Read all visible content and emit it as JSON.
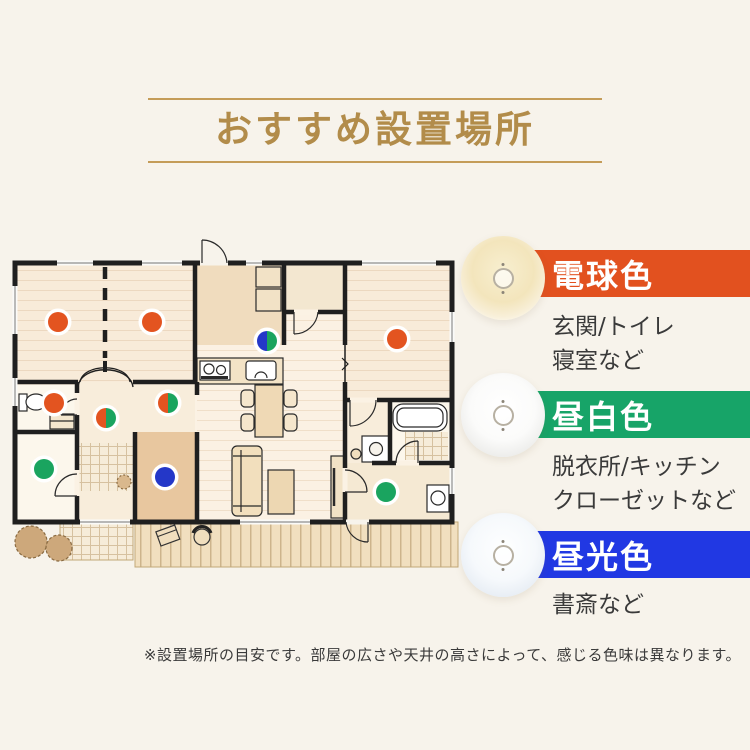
{
  "title": {
    "text": "おすすめ設置場所",
    "accent_color": "#B28C4A",
    "line_color": "#C49C58"
  },
  "legend": {
    "items": [
      {
        "label": "電球色",
        "banner_color": "#E2511F",
        "light_tint": "#F5E8C4",
        "desc_lines": [
          "玄関/トイレ",
          "寝室など"
        ]
      },
      {
        "label": "昼白色",
        "banner_color": "#17A468",
        "light_tint": "#FFFFFF",
        "desc_lines": [
          "脱衣所/キッチン",
          "クローゼットなど"
        ]
      },
      {
        "label": "昼光色",
        "banner_color": "#2138E3",
        "light_tint": "#F3F7FC",
        "desc_lines": [
          "書斎など"
        ]
      }
    ]
  },
  "footnote": {
    "text": "※設置場所の目安です。部屋の広さや天井の高さによって、感じる色味は異なります。"
  },
  "floorplan": {
    "dot_colors": {
      "warm": "#E35420",
      "neutral": "#1AA45F",
      "cool": "#2437C8"
    },
    "dots": [
      {
        "x": 58,
        "y": 92,
        "type": "warm",
        "room": "bedroom-1"
      },
      {
        "x": 152,
        "y": 92,
        "type": "warm",
        "room": "bedroom-2"
      },
      {
        "x": 397,
        "y": 109,
        "type": "warm",
        "room": "bedroom-3"
      },
      {
        "x": 267,
        "y": 111,
        "type": "cool_neutral",
        "room": "kitchen"
      },
      {
        "x": 54,
        "y": 173,
        "type": "warm",
        "room": "toilet"
      },
      {
        "x": 106,
        "y": 188,
        "type": "warm_neutral",
        "room": "entrance-hall"
      },
      {
        "x": 168,
        "y": 173,
        "type": "warm_neutral",
        "room": "hallway"
      },
      {
        "x": 44,
        "y": 239,
        "type": "neutral",
        "room": "closet"
      },
      {
        "x": 165,
        "y": 247,
        "type": "cool",
        "room": "study"
      },
      {
        "x": 386,
        "y": 262,
        "type": "neutral",
        "room": "washroom"
      }
    ]
  }
}
